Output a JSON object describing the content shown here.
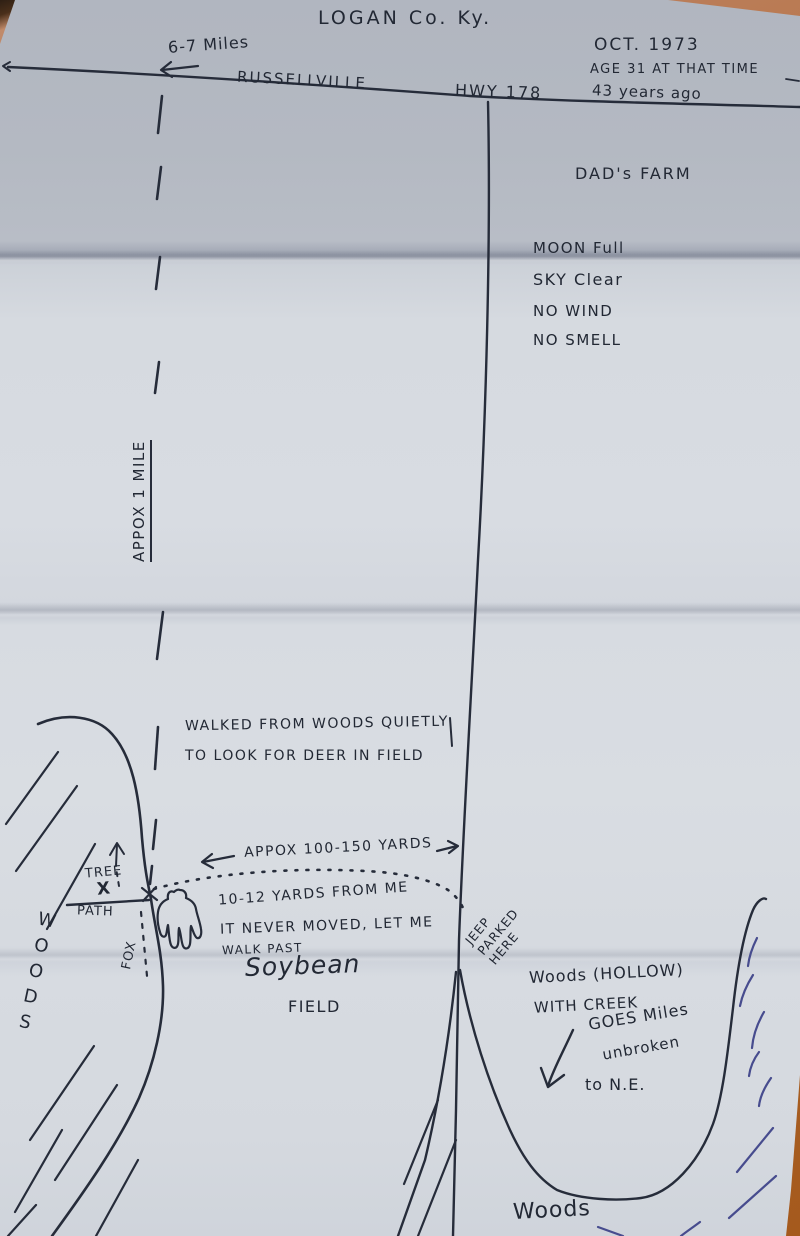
{
  "header": {
    "title": "LOGAN Co. Ky.",
    "distance_note": "6-7 Miles",
    "town": "RUSSELLVILLE",
    "highway": "HWY 178",
    "date": "OCT. 1973",
    "age_note": "AGE 31 AT THAT TIME",
    "years_ago": "43 years ago"
  },
  "farm": {
    "label": "DAD's FARM"
  },
  "conditions": {
    "moon": "MOON Full",
    "sky": "SKY Clear",
    "wind": "NO WIND",
    "smell": "NO SMELL"
  },
  "left_road": {
    "distance": "APPOX  1 MILE"
  },
  "narrative": {
    "walked1": "WALKED FROM WOODS QUIETLY",
    "walked2": "TO LOOK FOR DEER IN FIELD",
    "yards_range": "APPOX 100-150 YARDS",
    "encounter1": "10-12 YARDS FROM ME",
    "encounter2": "IT NEVER MOVED, LET ME",
    "encounter3": "WALK PAST"
  },
  "landmarks": {
    "tree": "TREE",
    "tree_mark": "X",
    "path": "PATH",
    "fox": "FOX",
    "woods_left": "WOODS",
    "soybean": "Soybean",
    "field": "FIELD",
    "jeep_line1": "JEEP",
    "jeep_line2": "PARKED",
    "jeep_line3": "HERE",
    "hollow1": "Woods (HOLLOW)",
    "hollow2": "WITH CREEK",
    "creek1": "GOES Miles",
    "creek2": "unbroken",
    "creek3": "to N.E.",
    "woods_bottom": "Woods"
  },
  "colors": {
    "ink": "#262c3a",
    "blue_ink": "#474c8e",
    "paper": "#d6dae0"
  }
}
